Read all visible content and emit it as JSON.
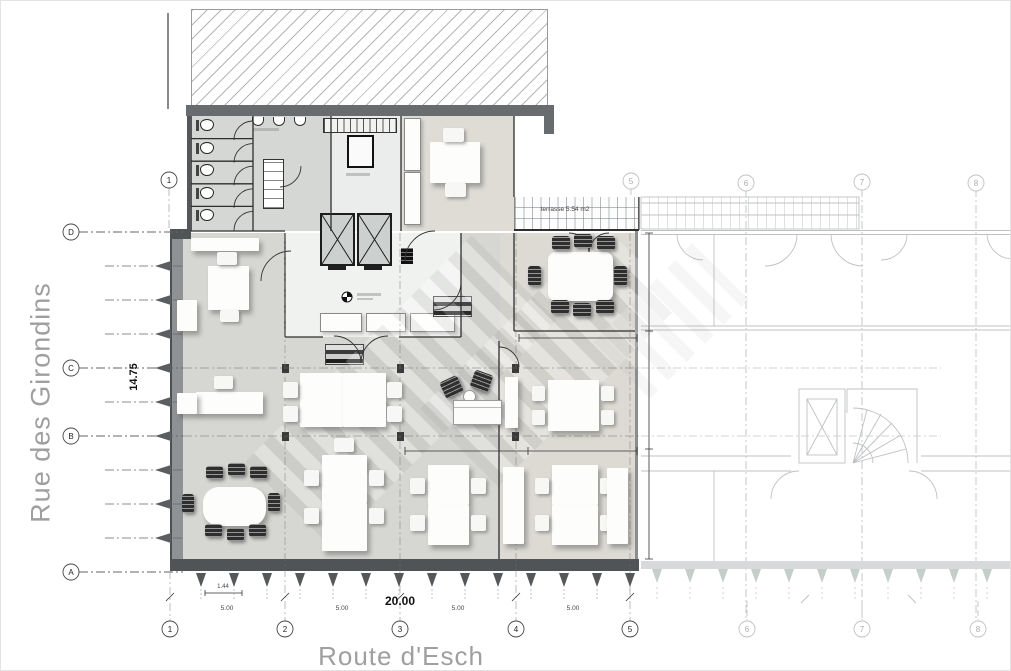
{
  "streets": {
    "left": "Rue des Girondins",
    "bottom": "Route d'Esch"
  },
  "dimensions": {
    "total_width": "20.00",
    "total_depth": "14.75",
    "bays": [
      "5.00",
      "5.00",
      "5.00",
      "5.00"
    ],
    "detail": "1.44",
    "terrace": "terrasse 5.54 m2"
  },
  "grid": {
    "left": [
      "D",
      "C",
      "B",
      "A"
    ],
    "bottom": [
      "1",
      "2",
      "3",
      "4",
      "5"
    ],
    "bottom_ghost": [
      "6",
      "7",
      "8"
    ],
    "top_left": "1",
    "top_ghost": [
      "5",
      "6",
      "7",
      "8"
    ]
  },
  "colors": {
    "floor": "#d6d6d2",
    "floor_right": "#dcdad3",
    "lobby": "#f0f2f0",
    "wall_dark": "#505456",
    "wall_gray": "#8e9294",
    "ghost": "#6f787c",
    "street_text": "#9f9f9f",
    "chair_dark": "#2e2e2e"
  },
  "icons": {
    "level_marker": "quartered-circle",
    "toilet": "wc-pan",
    "sink": "half-round-basin",
    "elevator": "crossed-box"
  }
}
